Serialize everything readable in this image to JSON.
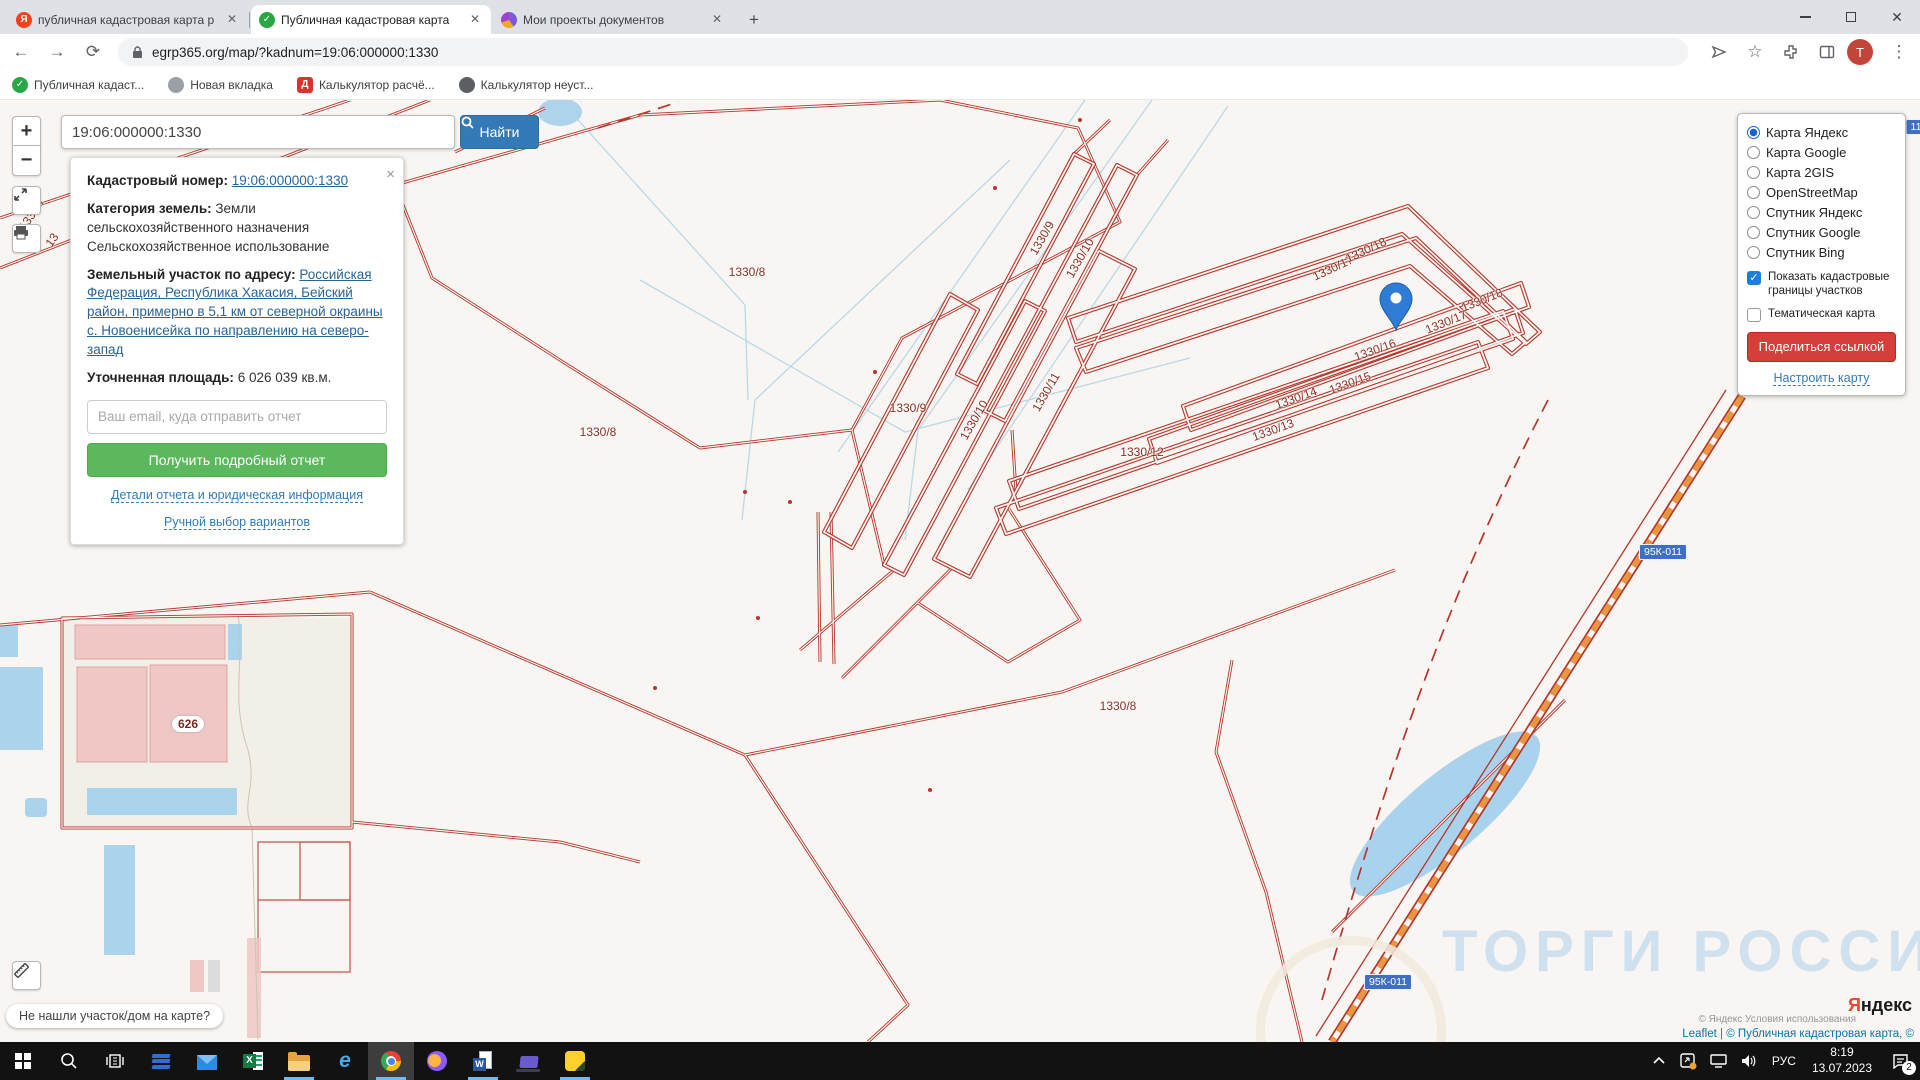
{
  "browser": {
    "tabs": [
      {
        "title": "публичная кадастровая карта р",
        "close": "✕"
      },
      {
        "title": "Публичная кадастровая карта",
        "close": "✕"
      },
      {
        "title": "Мои проекты документов",
        "close": "✕"
      }
    ],
    "new_tab": "+",
    "url": "egrp365.org/map/?kadnum=19:06:000000:1330",
    "bookmarks": [
      "Публичная кадаст...",
      "Новая вкладка",
      "Калькулятор расчё...",
      "Калькулятор неуст..."
    ],
    "bookmark_glyphs": [
      "✓",
      "●",
      "Д",
      "●"
    ],
    "avatar_letter": "Т",
    "window_controls": {
      "close": "✕"
    }
  },
  "search": {
    "value": "19:06:000000:1330",
    "button": "Найти"
  },
  "controls": {
    "zoom_in": "+",
    "zoom_out": "−"
  },
  "info_card": {
    "close": "×",
    "cadastral_label": "Кадастровый номер:",
    "cadastral_link": "19:06:000000:1330",
    "category_label": "Категория земель:",
    "category_value": "Земли сельскохозяйственного назначения",
    "category_sub": "Сельскохозяйственное использование",
    "address_label": "Земельный участок по адресу:",
    "address_link": "Российская Федерация, Республика Хакасия, Бейский район, примерно в 5,1 км от северной окраины с. Новоенисейка по направлению на северо-запад",
    "area_label": "Уточненная площадь:",
    "area_value": "6 026 039 кв.м.",
    "email_placeholder": "Ваш email, куда отправить отчет",
    "report_button": "Получить подробный отчет",
    "details_link": "Детали отчета и юридическая информация",
    "manual_link": "Ручной выбор вариантов"
  },
  "layers_panel": {
    "options": [
      {
        "label": "Карта Яндекс",
        "selected": true
      },
      {
        "label": "Карта Google",
        "selected": false
      },
      {
        "label": "Карта 2GIS",
        "selected": false
      },
      {
        "label": "OpenStreetMap",
        "selected": false
      },
      {
        "label": "Спутник Яндекс",
        "selected": false
      },
      {
        "label": "Спутник Google",
        "selected": false
      },
      {
        "label": "Спутник Bing",
        "selected": false
      }
    ],
    "checkboxes": [
      {
        "label": "Показать кадастровые границы участков",
        "checked": true
      },
      {
        "label": "Тематическая карта",
        "checked": false
      }
    ],
    "share_button": "Поделиться ссылкой",
    "configure_link": "Настроить карту"
  },
  "map": {
    "labels": [
      {
        "text": "1330/8",
        "x": 747,
        "y": 172,
        "rot": 0
      },
      {
        "text": "1330/9",
        "x": 1042,
        "y": 138,
        "rot": -60
      },
      {
        "text": "1330/10",
        "x": 1080,
        "y": 158,
        "rot": -60
      },
      {
        "text": "1330/9",
        "x": 908,
        "y": 308,
        "rot": 0
      },
      {
        "text": "1330/10",
        "x": 974,
        "y": 320,
        "rot": -60
      },
      {
        "text": "1330/11",
        "x": 1046,
        "y": 292,
        "rot": -60
      },
      {
        "text": "1330/8",
        "x": 598,
        "y": 332,
        "rot": 0
      },
      {
        "text": "1330/12",
        "x": 1142,
        "y": 352,
        "rot": 0
      },
      {
        "text": "1330/13",
        "x": 1273,
        "y": 330,
        "rot": -20
      },
      {
        "text": "1330/14",
        "x": 1296,
        "y": 298,
        "rot": -20
      },
      {
        "text": "1330/15",
        "x": 1350,
        "y": 283,
        "rot": -20
      },
      {
        "text": "1330/16",
        "x": 1375,
        "y": 250,
        "rot": -20
      },
      {
        "text": "1330/17",
        "x": 1333,
        "y": 168,
        "rot": -25
      },
      {
        "text": "1330/18",
        "x": 1366,
        "y": 150,
        "rot": -25
      },
      {
        "text": "1330/17",
        "x": 1446,
        "y": 222,
        "rot": -22
      },
      {
        "text": "1330/18",
        "x": 1482,
        "y": 200,
        "rot": -22
      },
      {
        "text": "1330/8",
        "x": 1118,
        "y": 606,
        "rot": 0
      },
      {
        "text": "1330/7",
        "x": 32,
        "y": 114,
        "rot": -55
      },
      {
        "text": "13",
        "x": 52,
        "y": 140,
        "rot": -55
      },
      {
        "text": "626",
        "x": 188,
        "y": 624,
        "rot": 0,
        "badge": true
      }
    ],
    "road_shields": [
      {
        "text": "95К-011",
        "x": 1663,
        "y": 452
      },
      {
        "text": "95К-011",
        "x": 1388,
        "y": 882
      },
      {
        "text": "11",
        "x": 1916,
        "y": 27
      }
    ],
    "watermark": "ТОРГИ РОССИИ",
    "tooltip": "Не нашли участок/дом на карте?",
    "attribution": {
      "leaflet": "Leaflet",
      "divider": " | ",
      "text": "© Публичная кадастровая карта, ©",
      "yandex_terms": "© Яндекс Условия использования",
      "yandex_logo_first": "Я",
      "yandex_logo_rest": "ндекс"
    }
  },
  "taskbar": {
    "lang": "РУС",
    "time": "8:19",
    "date": "13.07.2023",
    "badge": "2"
  },
  "colors": {
    "parcel_line": "#b5362b",
    "parcel_label": "#8a3023",
    "map_bg": "#f8f5f2",
    "water": "#a9d2ec",
    "building": "#efc7c5",
    "accent_blue_button": "#337ab7",
    "green_button": "#5cb85c",
    "red_button": "#d43f3a",
    "checkbox_blue": "#1f7ce0",
    "marker_blue": "#2e7cd6",
    "road_shield": "#3f6fc4",
    "taskbar_bg": "#121212"
  }
}
